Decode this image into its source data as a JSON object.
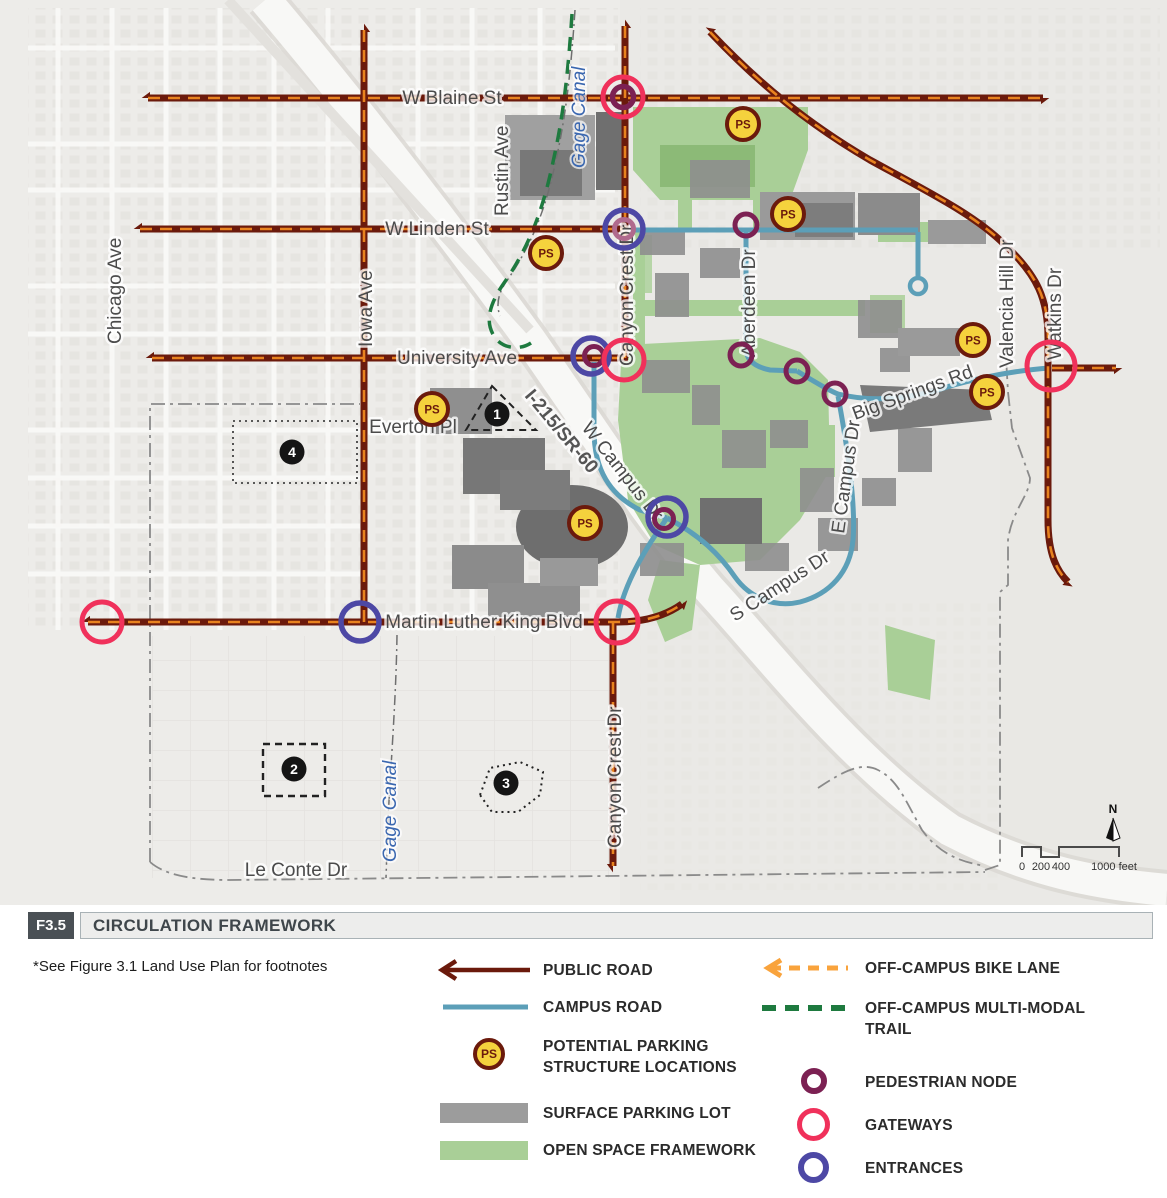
{
  "title": {
    "figure_no": "F3.5",
    "text": "CIRCULATION FRAMEWORK"
  },
  "footnote": "*See Figure 3.1 Land Use Plan for footnotes",
  "legend": {
    "public_road": "PUBLIC ROAD",
    "campus_road": "CAMPUS ROAD",
    "ps_line1": "POTENTIAL PARKING",
    "ps_line2": "STRUCTURE LOCATIONS",
    "surface_parking": "SURFACE PARKING LOT",
    "open_space": "OPEN SPACE FRAMEWORK",
    "bike_lane": "OFF-CAMPUS BIKE LANE",
    "trail_line1": "OFF-CAMPUS MULTI-MODAL",
    "trail_line2": "TRAIL",
    "pedestrian_node": "PEDESTRIAN NODE",
    "gateways": "GATEWAYS",
    "entrances": "ENTRANCES"
  },
  "map": {
    "ps_label": "PS",
    "marker_labels": [
      "1",
      "2",
      "3",
      "4"
    ],
    "streets": {
      "w_blaine": "W Blaine St",
      "w_linden": "W Linden St",
      "university": "University Ave",
      "everton": "Everton Pl",
      "mlk": "Martin Luther King Blvd",
      "le_conte": "Le Conte Dr",
      "chicago": "Chicago Ave",
      "iowa": "Iowa Ave",
      "rustin": "Rustin Ave",
      "gage_canal": "Gage Canal",
      "canyon_crest": "Canyon Crest Dr",
      "aberdeen": "Aberdeen Dr",
      "valencia": "Valencia Hill Dr",
      "watkins": "Watkins Dr",
      "big_springs": "Big Springs Rd",
      "w_campus": "W Campus Dr",
      "e_campus": "E Campus Dr",
      "s_campus": "S Campus Dr",
      "freeway": "I-215/SR-60"
    },
    "compass_north": "N",
    "scale": {
      "t0": "0",
      "t200": "200",
      "t400": "400",
      "t1000": "1000 feet"
    }
  },
  "colors": {
    "public_road": "#6b1a0c",
    "road_dash": "#e8831f",
    "campus_road": "#5c9fb8",
    "bike_lane": "#f9a33c",
    "multi_modal_trail": "#1e7a3f",
    "pedestrian_node": "#7c2153",
    "gateway": "#f0315b",
    "entrance": "#4d48a5",
    "ps_fill": "#f5d23d",
    "open_space": "#a9cf97",
    "surface_parking": "#9c9c9c"
  }
}
